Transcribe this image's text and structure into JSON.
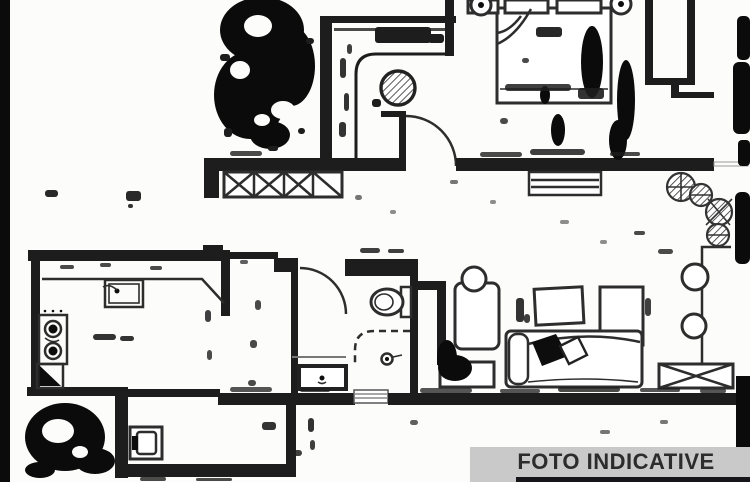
{
  "banner": {
    "label": "FOTO INDICATIVE"
  },
  "palette": {
    "paper": "#fcfcfa",
    "ink": "#1d1d1d",
    "banner_bg": "#c9c9c9",
    "banner_text": "#2c2c2c",
    "bottom_strip": "#16161a"
  },
  "diagram": {
    "type": "floor-plan",
    "description": "Scanned monochrome apartment floor plan with ink scan-noise artifacts",
    "rooms": [
      {
        "name": "hallway",
        "features": [
          "round-hatched-table",
          "door-arc",
          "window-sill-x-hatch"
        ]
      },
      {
        "name": "bedroom",
        "features": [
          "double-bed",
          "pillows",
          "nightstand-lamp-left",
          "nightstand-lamp-right",
          "radiator"
        ]
      },
      {
        "name": "balcony",
        "features": [
          "potted-plants",
          "stool-circles",
          "floor-grate-x-box"
        ]
      },
      {
        "name": "living-room",
        "features": [
          "armchair",
          "plant-circle",
          "tilted-frame",
          "cabinet",
          "sofa",
          "bench"
        ]
      },
      {
        "name": "bathroom",
        "features": [
          "toilet",
          "shower-dashed",
          "drain",
          "washbasin",
          "door-arc",
          "threshold"
        ]
      },
      {
        "name": "kitchen",
        "features": [
          "counter",
          "sink",
          "stove-two-burners",
          "corner-unit"
        ]
      },
      {
        "name": "laundry-room",
        "features": [
          "washing-machine"
        ]
      }
    ]
  },
  "scan_noise": {
    "blob_ellipses": [
      [
        262,
        30,
        42,
        33
      ],
      [
        250,
        95,
        36,
        44
      ],
      [
        291,
        66,
        24,
        40
      ],
      [
        270,
        135,
        20,
        14
      ],
      [
        592,
        62,
        11,
        36
      ],
      [
        626,
        100,
        9,
        40
      ],
      [
        558,
        130,
        7,
        16
      ],
      [
        545,
        95,
        5,
        9
      ],
      [
        618,
        140,
        9,
        20
      ],
      [
        455,
        368,
        17,
        13
      ],
      [
        447,
        358,
        10,
        18
      ],
      [
        65,
        437,
        40,
        34
      ],
      [
        95,
        461,
        20,
        13
      ],
      [
        40,
        470,
        15,
        8
      ]
    ],
    "white_holes": [
      [
        258,
        26,
        14,
        11
      ],
      [
        240,
        70,
        10,
        9
      ],
      [
        283,
        110,
        12,
        9
      ],
      [
        262,
        120,
        8,
        6
      ],
      [
        58,
        431,
        16,
        12
      ],
      [
        80,
        452,
        8,
        6
      ]
    ],
    "speckle_rects": [
      [
        220,
        54,
        10,
        7,
        1
      ],
      [
        306,
        38,
        8,
        6,
        1
      ],
      [
        224,
        128,
        8,
        9,
        1
      ],
      [
        298,
        128,
        7,
        6,
        1
      ],
      [
        268,
        146,
        10,
        5,
        1
      ],
      [
        375,
        27,
        56,
        16,
        1
      ],
      [
        428,
        34,
        16,
        9,
        1
      ],
      [
        340,
        58,
        6,
        20,
        0.9
      ],
      [
        344,
        93,
        5,
        18,
        0.9
      ],
      [
        339,
        122,
        7,
        15,
        0.9
      ],
      [
        347,
        44,
        5,
        10,
        0.85
      ],
      [
        536,
        27,
        26,
        10,
        0.95
      ],
      [
        505,
        84,
        66,
        7,
        0.85
      ],
      [
        578,
        88,
        26,
        11,
        0.9
      ],
      [
        500,
        118,
        8,
        6,
        0.8
      ],
      [
        522,
        58,
        7,
        5,
        0.8
      ],
      [
        45,
        190,
        13,
        7,
        0.95
      ],
      [
        126,
        191,
        15,
        10,
        0.95
      ],
      [
        128,
        204,
        5,
        4,
        0.9
      ],
      [
        60,
        265,
        14,
        4,
        0.8
      ],
      [
        100,
        263,
        11,
        4,
        0.8
      ],
      [
        150,
        266,
        12,
        4,
        0.8
      ],
      [
        93,
        334,
        23,
        6,
        0.9
      ],
      [
        120,
        336,
        14,
        5,
        0.9
      ],
      [
        360,
        248,
        20,
        5,
        0.85
      ],
      [
        388,
        249,
        16,
        4,
        0.85
      ],
      [
        658,
        249,
        15,
        5,
        0.8
      ],
      [
        634,
        231,
        11,
        4,
        0.8
      ],
      [
        516,
        298,
        8,
        24,
        0.9
      ],
      [
        524,
        314,
        6,
        9,
        0.85
      ],
      [
        645,
        298,
        6,
        18,
        0.85
      ],
      [
        230,
        151,
        32,
        5,
        0.8
      ],
      [
        480,
        152,
        42,
        5,
        0.8
      ],
      [
        530,
        149,
        55,
        6,
        0.85
      ],
      [
        610,
        152,
        30,
        4,
        0.8
      ],
      [
        230,
        387,
        42,
        5,
        0.75
      ],
      [
        300,
        388,
        30,
        4,
        0.75
      ],
      [
        420,
        388,
        52,
        5,
        0.75
      ],
      [
        500,
        389,
        40,
        4,
        0.75
      ],
      [
        558,
        387,
        62,
        5,
        0.8
      ],
      [
        640,
        388,
        40,
        4,
        0.75
      ],
      [
        700,
        389,
        26,
        4,
        0.75
      ],
      [
        140,
        477,
        26,
        4,
        0.8
      ],
      [
        196,
        478,
        36,
        3,
        0.8
      ],
      [
        262,
        422,
        14,
        8,
        0.9
      ],
      [
        292,
        450,
        10,
        6,
        0.85
      ],
      [
        308,
        418,
        6,
        14,
        0.9
      ],
      [
        310,
        440,
        5,
        10,
        0.85
      ],
      [
        410,
        420,
        8,
        5,
        0.7
      ],
      [
        600,
        430,
        10,
        4,
        0.6
      ],
      [
        660,
        420,
        8,
        4,
        0.6
      ],
      [
        450,
        180,
        8,
        4,
        0.6
      ],
      [
        490,
        200,
        6,
        4,
        0.5
      ],
      [
        560,
        220,
        9,
        4,
        0.5
      ],
      [
        600,
        240,
        7,
        4,
        0.5
      ],
      [
        355,
        195,
        7,
        5,
        0.6
      ],
      [
        390,
        210,
        6,
        4,
        0.5
      ],
      [
        240,
        260,
        8,
        4,
        0.7
      ],
      [
        255,
        300,
        6,
        10,
        0.8
      ],
      [
        250,
        340,
        7,
        8,
        0.8
      ],
      [
        248,
        380,
        8,
        6,
        0.8
      ],
      [
        205,
        310,
        6,
        12,
        0.85
      ],
      [
        207,
        350,
        5,
        10,
        0.8
      ],
      [
        372,
        99,
        9,
        8,
        1
      ]
    ],
    "edge_bars": [
      [
        0,
        0,
        10,
        482,
        0
      ],
      [
        737,
        16,
        13,
        44,
        5
      ],
      [
        733,
        62,
        17,
        72,
        6
      ],
      [
        738,
        140,
        12,
        26,
        4
      ],
      [
        735,
        192,
        15,
        72,
        6
      ],
      [
        736,
        376,
        14,
        71,
        0
      ]
    ]
  }
}
